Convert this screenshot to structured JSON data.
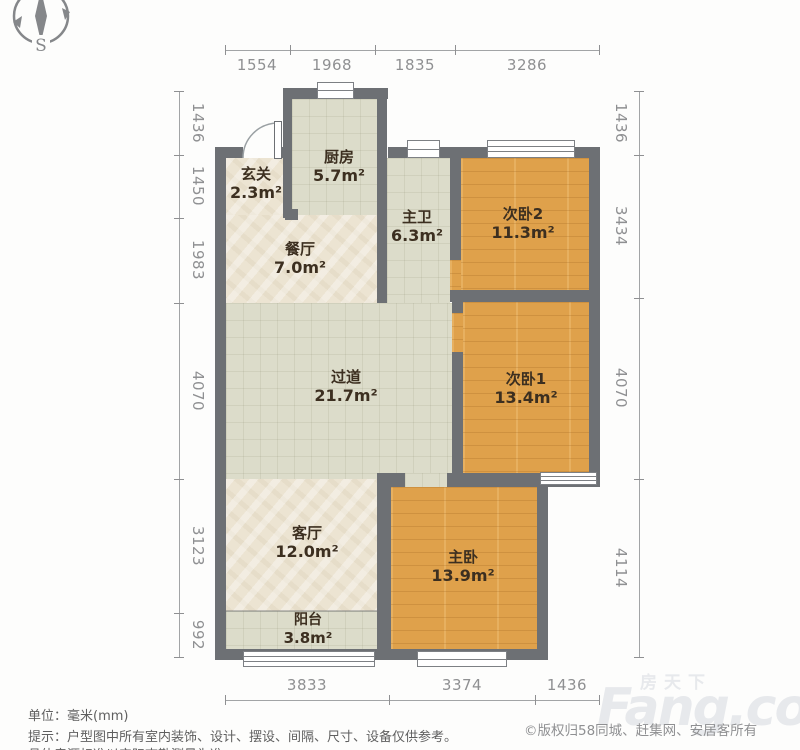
{
  "compass": {
    "label": "S"
  },
  "dimensions": {
    "top": [
      "1554",
      "1968",
      "1835",
      "3286"
    ],
    "left": [
      "1436",
      "1450",
      "1983",
      "4070",
      "3123",
      "992"
    ],
    "right": [
      "1436",
      "3434",
      "4070",
      "4114"
    ],
    "bottom": [
      "3833",
      "3374",
      "1436"
    ]
  },
  "rooms": [
    {
      "name": "玄关",
      "area": "2.3m²"
    },
    {
      "name": "厨房",
      "area": "5.7m²"
    },
    {
      "name": "餐厅",
      "area": "7.0m²"
    },
    {
      "name": "主卫",
      "area": "6.3m²"
    },
    {
      "name": "次卧2",
      "area": "11.3m²"
    },
    {
      "name": "次卧1",
      "area": "13.4m²"
    },
    {
      "name": "过道",
      "area": "21.7m²"
    },
    {
      "name": "客厅",
      "area": "12.0m²"
    },
    {
      "name": "主卧",
      "area": "13.9m²"
    },
    {
      "name": "阳台",
      "area": "3.8m²"
    }
  ],
  "footer": {
    "unit": "单位：毫米(mm)",
    "tip": "提示：户型图中所有室内装饰、设计、摆设、间隔、尺寸、设备仅供参考。",
    "tip2": "具体房源标准以实际查勘测量为准。",
    "copyright": "©版权归58同城、赶集网、安居客所有"
  },
  "watermark": {
    "cn": "房天下",
    "en": "Fang.com"
  },
  "colors": {
    "wall": "#6d7074",
    "wood_floor": "#dfa14b",
    "tile_floor": "#dcdcca",
    "cream_floor": "#ece4d2",
    "dim_text": "#8f9092",
    "label_text": "#3c2f20"
  }
}
